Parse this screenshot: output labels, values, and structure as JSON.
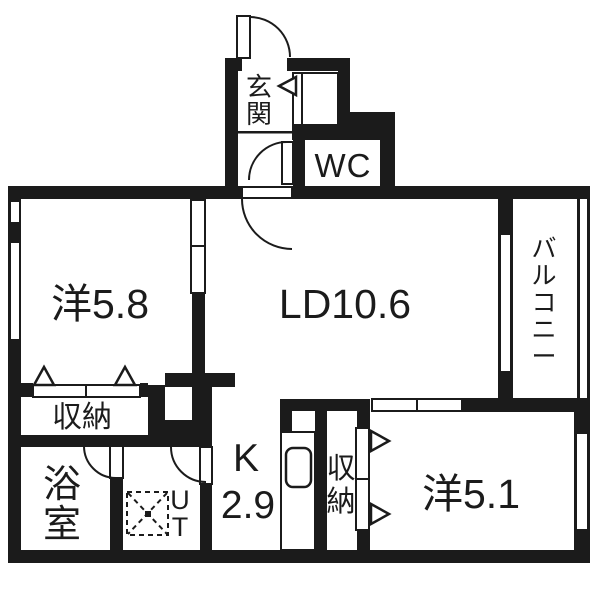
{
  "plan": {
    "rooms": {
      "entrance": {
        "label": "玄関"
      },
      "wc": {
        "label": "WC"
      },
      "living_dining": {
        "label": "LD10.6"
      },
      "western_room_a": {
        "label": "洋5.8"
      },
      "western_room_b": {
        "label": "洋5.1"
      },
      "kitchen": {
        "label": "K",
        "size": "2.9"
      },
      "bathroom": {
        "label": "浴室"
      },
      "utility": {
        "label": "UT"
      },
      "storage_hall": {
        "label": "収納"
      },
      "storage_bedroom": {
        "label": "収納"
      },
      "balcony": {
        "label": "バルコニー"
      }
    },
    "colors": {
      "wall": "#1b1b1b",
      "floor": "#ffffff"
    }
  }
}
